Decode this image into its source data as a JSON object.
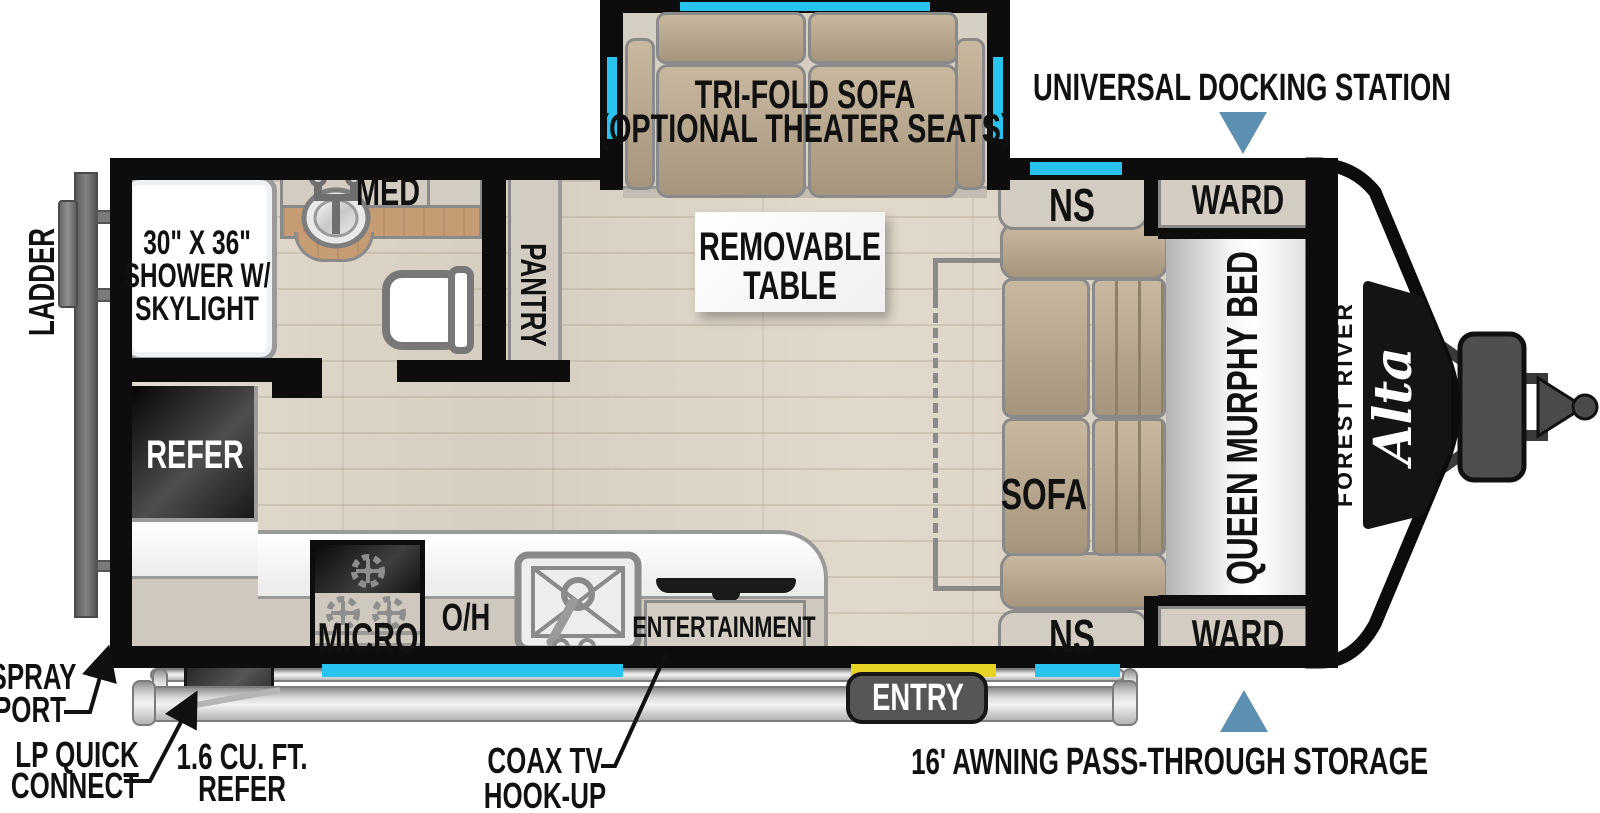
{
  "colors": {
    "window": "#29c3f0",
    "door": "#e6d323",
    "arrow": "#5d90b0",
    "wall": "#0d0d0d",
    "cabinet": "#d3ccc3",
    "beige": "#cfc8bf",
    "wood": "#c59c73",
    "floor": "#dcd4c6"
  },
  "brand": {
    "maker": "FOREST RIVER",
    "model": "Alta"
  },
  "slideout": {
    "label_line1": "TRI-FOLD SOFA",
    "label_line2": "(OPTIONAL THEATER SEATS)"
  },
  "rooms": {
    "shower_line1": "30\" X 36\"",
    "shower_line2": "SHOWER W/",
    "shower_line3": "SKYLIGHT",
    "med": "MED",
    "pantry": "PANTRY",
    "refer": "REFER",
    "micro": "MICRO",
    "oh": "O/H",
    "entertainment": "ENTERTAINMENT",
    "table_line1": "REMOVABLE",
    "table_line2": "TABLE",
    "sofa": "SOFA",
    "murphy_bed": "QUEEN MURPHY BED",
    "ns": "NS",
    "ward": "WARD"
  },
  "callouts": {
    "docking": "UNIVERSAL DOCKING STATION",
    "pass_through": "PASS-THROUGH STORAGE",
    "awning": "16' AWNING",
    "entry": "ENTRY",
    "coax_line1": "COAX TV",
    "coax_line2": "HOOK-UP",
    "refer16_line1": "1.6 CU. FT.",
    "refer16_line2": "REFER",
    "lp_line1": "LP QUICK",
    "lp_line2": "CONNECT",
    "spray_line1": "SPRAY",
    "spray_line2": "PORT",
    "ladder": "LADDER"
  }
}
